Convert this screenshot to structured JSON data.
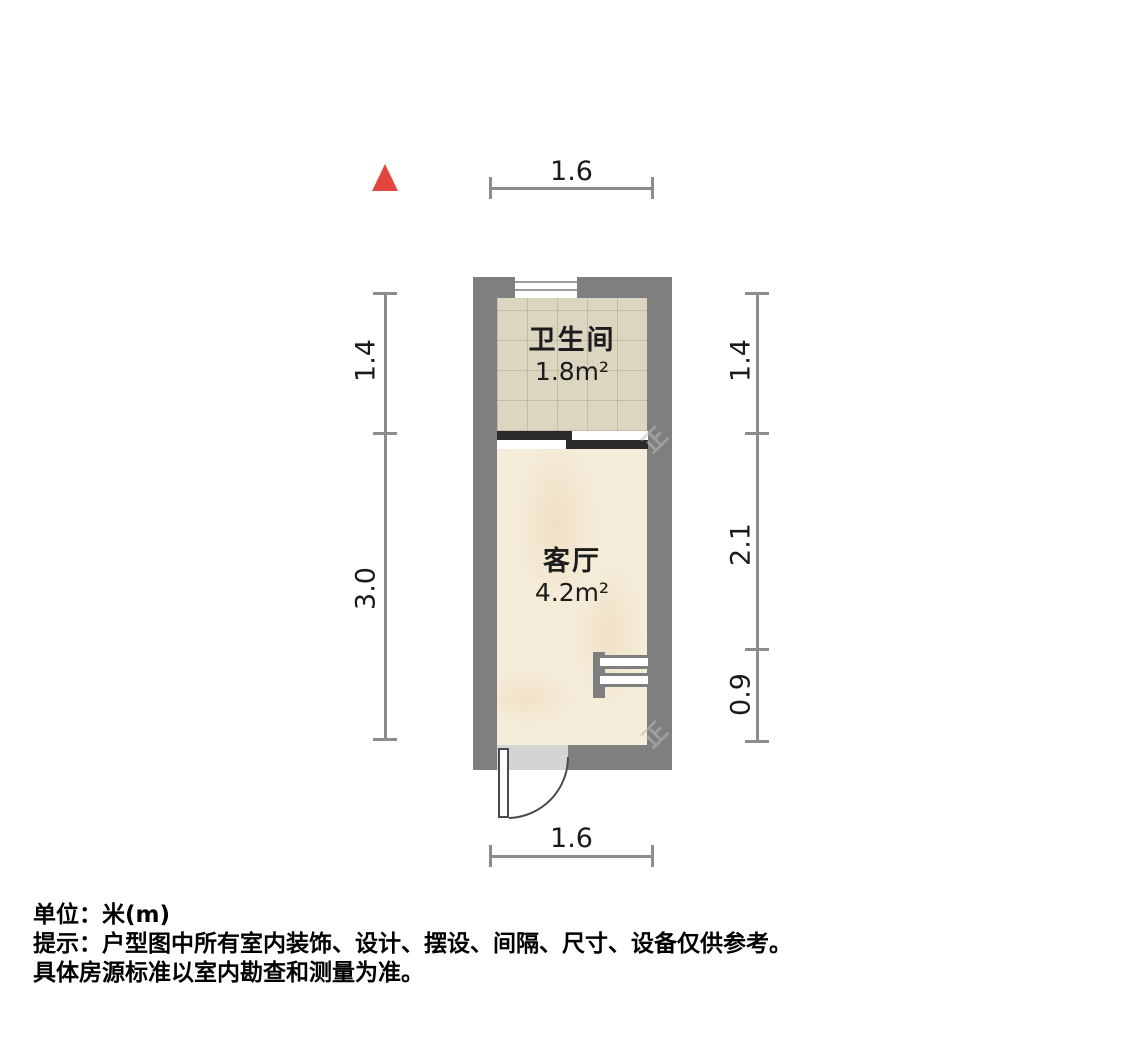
{
  "plan": {
    "north_indicator": "north-arrow",
    "rooms": {
      "bathroom": {
        "name": "卫生间",
        "area": "1.8m²"
      },
      "living": {
        "name": "客厅",
        "area": "4.2m²"
      }
    },
    "dims": {
      "top": "1.6",
      "bottom": "1.6",
      "left_upper": "1.4",
      "left_lower": "3.0",
      "right_upper": "1.4",
      "right_middle": "2.1",
      "right_lower": "0.9"
    },
    "colors": {
      "wall": "#7f7f7f",
      "bathroom_floor": "#dcd5c0",
      "living_floor": "#f5ecd9",
      "dimension_line": "#8c8c8c",
      "north_arrow": "#e2473f",
      "sliding_door_dark": "#2b2b2b",
      "door_opening": "#d4d4d4"
    }
  },
  "watermark": {
    "text": "正"
  },
  "footer": {
    "unit": "单位：米(m)",
    "tip1": "提示：户型图中所有室内装饰、设计、摆设、间隔、尺寸、设备仅供参考。",
    "tip2": "具体房源标准以室内勘查和测量为准。"
  }
}
